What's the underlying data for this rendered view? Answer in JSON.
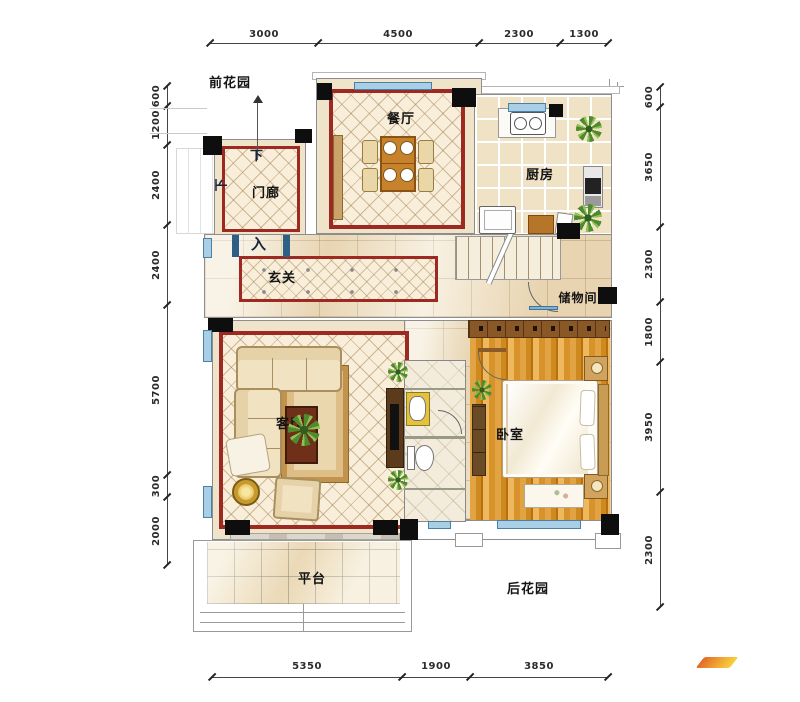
{
  "plan": {
    "rooms": {
      "front_garden": "前花园",
      "dining": "餐厅",
      "kitchen": "厨房",
      "porch": "门廊",
      "foyer": "玄关",
      "storage": "储物间",
      "living": "客厅",
      "bedroom": "卧室",
      "terrace": "平台",
      "back_garden": "后花园"
    },
    "marks": {
      "down_top": "下",
      "down_left": "下",
      "enter": "入"
    },
    "dims": {
      "top": [
        "3000",
        "4500",
        "2300",
        "1300"
      ],
      "bottom": [
        "5350",
        "1900",
        "3850"
      ],
      "left": [
        "600",
        "1200",
        "2400",
        "2400",
        "5700",
        "300",
        "2000"
      ],
      "right": [
        "600",
        "3650",
        "2300",
        "1800",
        "3950",
        "2300"
      ]
    },
    "colors": {
      "wall_red": "#9d2a22",
      "column_black": "#0e0e0e",
      "window_blue": "#a9cfe6",
      "wood_orange": "#d28f2b",
      "logo_orange": "#ef8a2a"
    }
  }
}
